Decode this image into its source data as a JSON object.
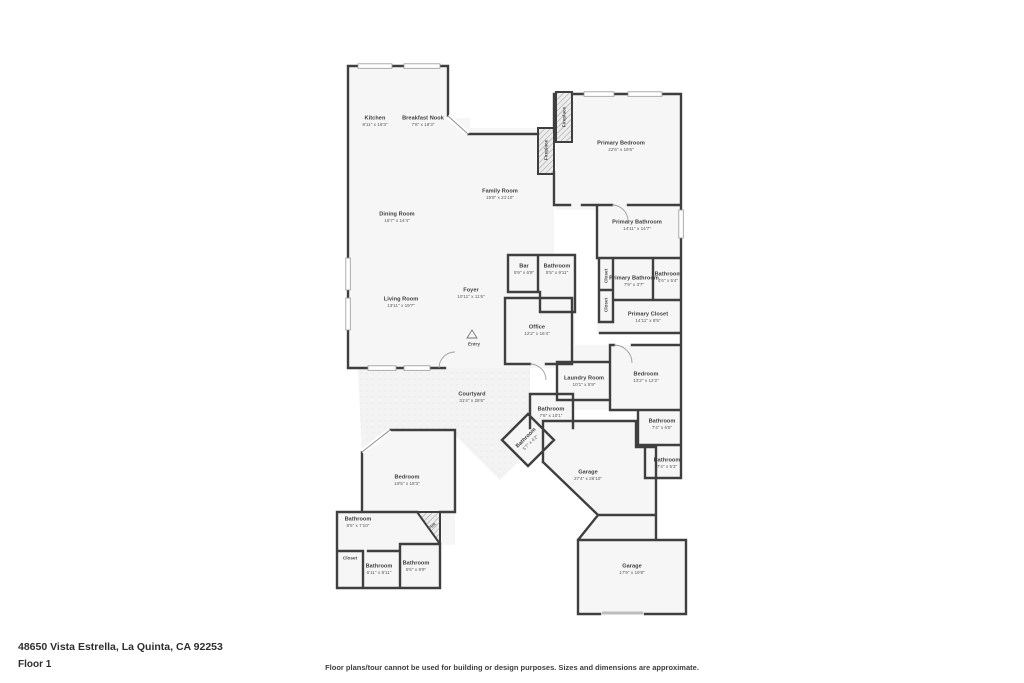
{
  "colors": {
    "wall": "#3f3f3f",
    "room_fill": "#f6f6f6",
    "courtyard_fill": "#f3f3f3",
    "page": "#ffffff"
  },
  "rooms": [
    {
      "name": "Kitchen",
      "dims": "8'11\" x 19'3\""
    },
    {
      "name": "Breakfast Nook",
      "dims": "7'8\" x 19'3\""
    },
    {
      "name": "Family Room",
      "dims": "19'8\" x 21'10\""
    },
    {
      "name": "Primary Bedroom",
      "dims": "22'6\" x 19'6\""
    },
    {
      "name": "Dining Room",
      "dims": "16'7\" x 14'4\""
    },
    {
      "name": "Primary Bathroom",
      "dims": "14'11\" x 14'7\""
    },
    {
      "name": "Bar",
      "dims": "5'9\" x 6'9\""
    },
    {
      "name": "Bathroom",
      "dims": "5'5\" x 9'11\""
    },
    {
      "name": "Living Room",
      "dims": "13'11\" x 19'7\""
    },
    {
      "name": "Foyer",
      "dims": "10'11\" x 11'6\""
    },
    {
      "name": "Primary Bathroom",
      "dims": "7'9\" x 3'7\""
    },
    {
      "name": "Bathroom",
      "dims": "4'6\" x 5'4\""
    },
    {
      "name": "Primary Closet",
      "dims": "14'11\" x 8'5\""
    },
    {
      "name": "Office",
      "dims": "12'2\" x 16'4\""
    },
    {
      "name": "Laundry Room",
      "dims": "10'1\" x 5'9\""
    },
    {
      "name": "Bedroom",
      "dims": "13'2\" x 12'2\""
    },
    {
      "name": "Courtyard",
      "dims": "31'4\" x 28'6\""
    },
    {
      "name": "Bathroom",
      "dims": "7'6\" x 10'1\""
    },
    {
      "name": "Bathroom",
      "dims": "5'7\" x 4'2\""
    },
    {
      "name": "Bathroom",
      "dims": "7'4\" x 6'5\""
    },
    {
      "name": "Bathroom",
      "dims": "7'4\" x 5'3\""
    },
    {
      "name": "Garage",
      "dims": "27'4\" x 26'10\""
    },
    {
      "name": "Bedroom",
      "dims": "19'5\" x 18'3\""
    },
    {
      "name": "Bathroom",
      "dims": "8'5\" x 7'10\""
    },
    {
      "name": "Bathroom",
      "dims": "6'11\" x 8'11\""
    },
    {
      "name": "Bathroom",
      "dims": "5'5\" x 8'9\""
    },
    {
      "name": "Garage",
      "dims": "17'9\" x 19'8\""
    }
  ],
  "annotations": [
    {
      "text": "Fireplace"
    },
    {
      "text": "Fireplace"
    },
    {
      "text": "Closet"
    },
    {
      "text": "Closet"
    },
    {
      "text": "Entry"
    },
    {
      "text": "Fire"
    },
    {
      "text": "Closet"
    }
  ],
  "footer": {
    "address": "48650 Vista Estrella, La Quinta, CA 92253",
    "floor_label": "Floor 1",
    "disclaimer": "Floor plans/tour cannot be used for building or design purposes. Sizes and dimensions are approximate."
  }
}
